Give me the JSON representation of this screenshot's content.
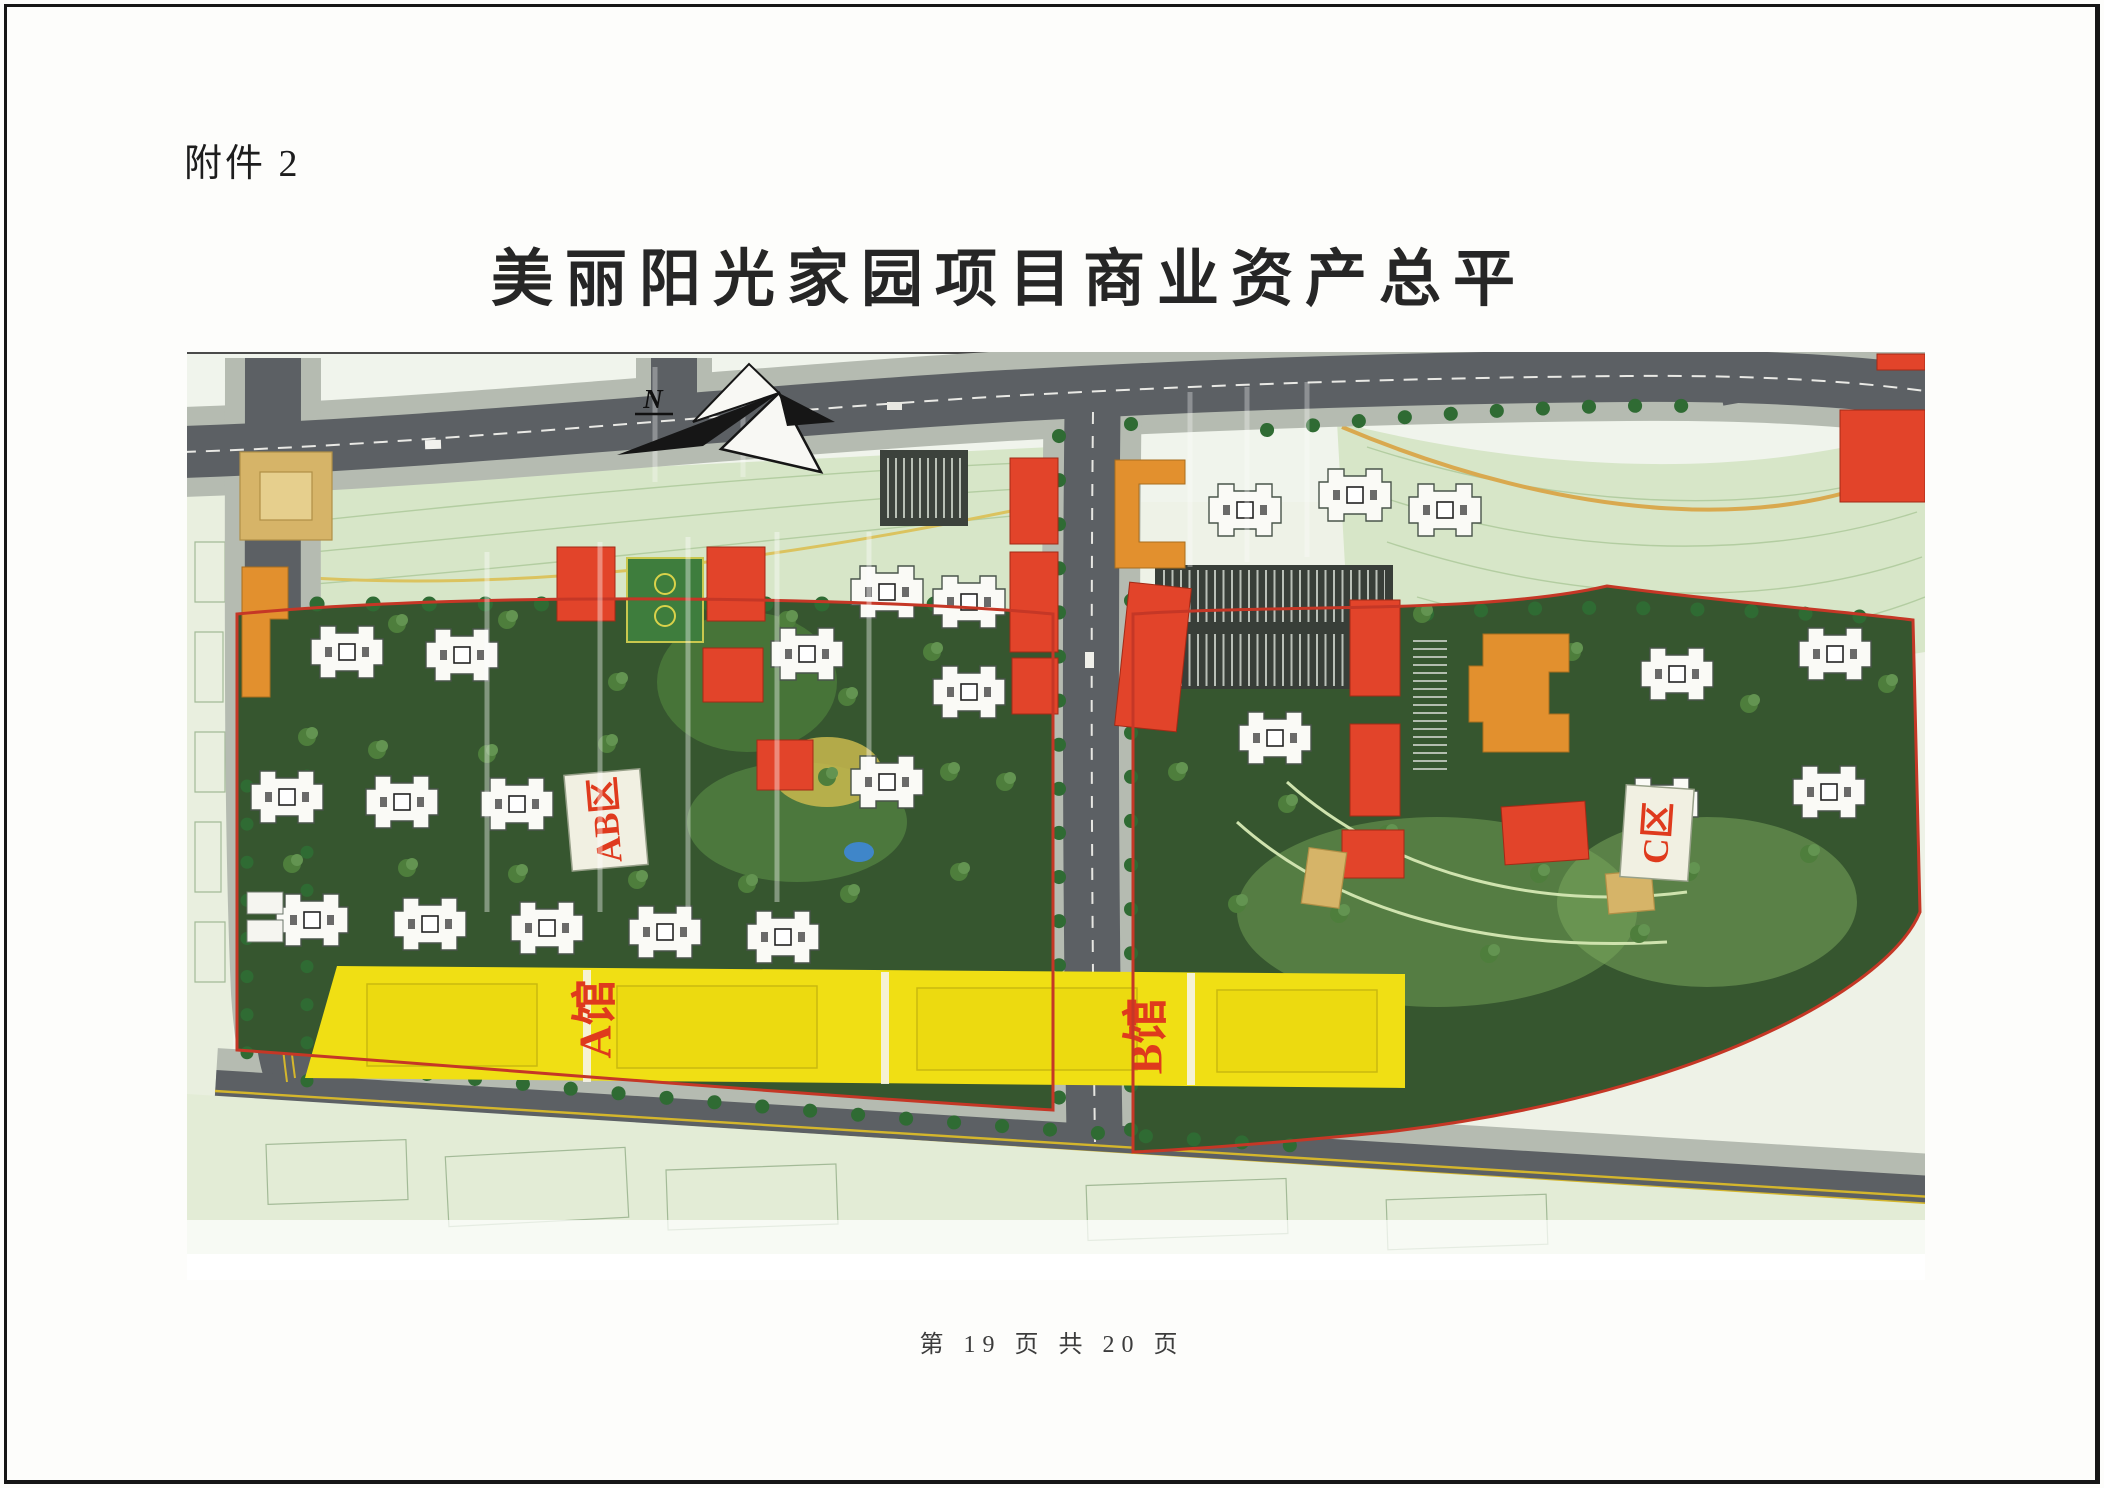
{
  "page": {
    "attachment_label": "附件 2",
    "title": "美丽阳光家园项目商业资产总平",
    "footer": "第 19 页 共 20 页"
  },
  "map": {
    "north_label": "N",
    "zone_labels": {
      "ab": "AB区",
      "c": "C区"
    },
    "hall_labels": {
      "a": "A馆",
      "b": "B馆"
    },
    "colors": {
      "commercial_strip_yellow": "#f0df14",
      "label_red": "#df3a1d",
      "building_red": "#e2442a",
      "building_orange": "#e2902e",
      "building_tan": "#d6b468",
      "road_gray": "#5c6064",
      "sidewalk_gray": "#b5bbb1",
      "parcel_green": "#36562f",
      "hill_green": "#d7e6c8",
      "boundary_red": "#c53726"
    }
  }
}
